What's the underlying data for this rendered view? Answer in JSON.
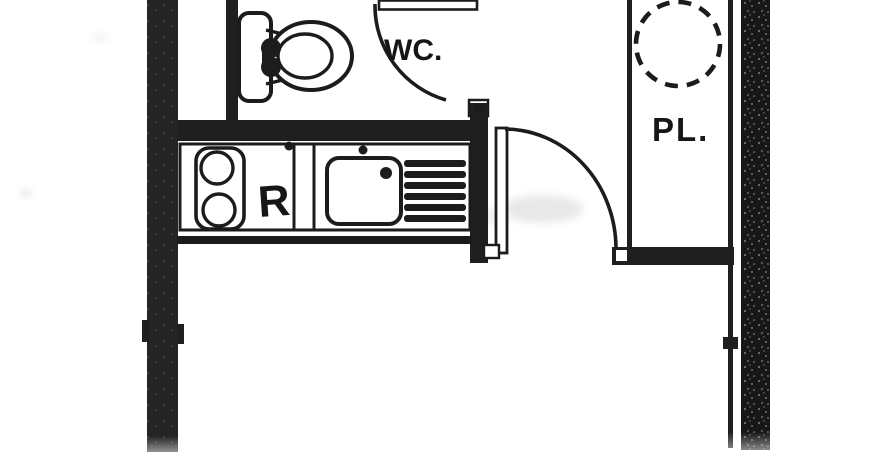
{
  "plan": {
    "type": "scanned-floor-plan",
    "labels": {
      "wc": "WC.",
      "closet": "PL.",
      "stove": "R"
    },
    "rooms": [
      {
        "name": "wc-room",
        "label": "WC."
      },
      {
        "name": "closet",
        "label": "PL."
      },
      {
        "name": "kitchen",
        "label": ""
      },
      {
        "name": "main-room",
        "label": ""
      }
    ],
    "fixtures": [
      "toilet",
      "stove-two-burners",
      "kitchen-sink",
      "dish-drainer",
      "water-heater-dashed-circle",
      "door-swing-wc",
      "door-swing-entry"
    ],
    "colors": {
      "wall": "#1f1f1f",
      "line": "#1c1c1c",
      "background": "#ffffff",
      "watermark": "#e6e6e6"
    }
  }
}
